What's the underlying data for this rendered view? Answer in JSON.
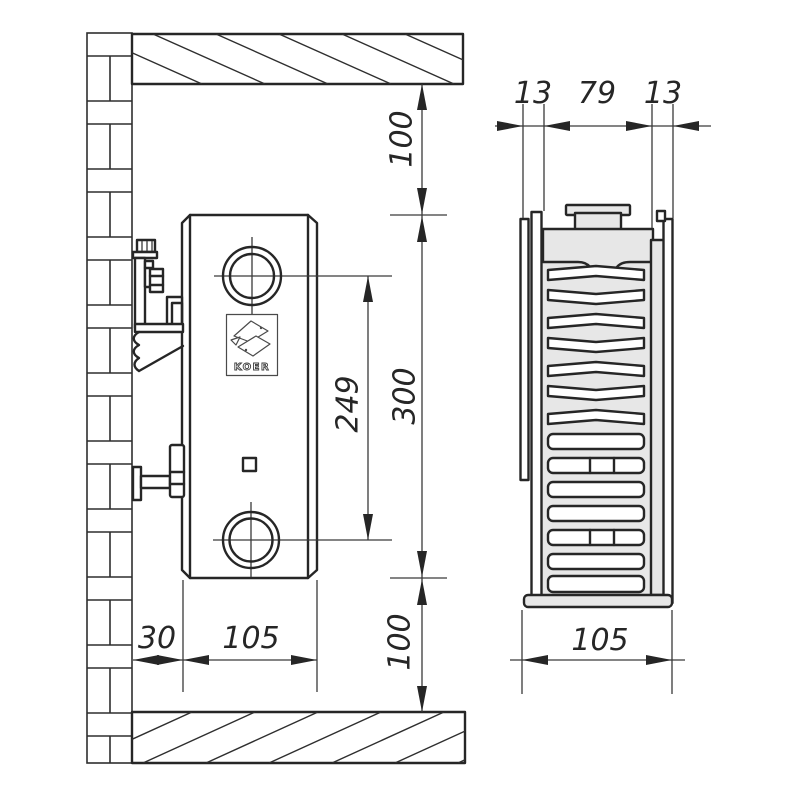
{
  "brand": {
    "logo_text": "KOER"
  },
  "front_view": {
    "top_clearance": "100",
    "radiator_height": "300",
    "port_spacing": "249",
    "bottom_clearance": "100",
    "wall_offset": "30",
    "width": "105"
  },
  "side_view": {
    "front_panel": "13",
    "core": "79",
    "back_panel": "13",
    "depth": "105"
  },
  "colors": {
    "line": "#262626",
    "light_fill": "#e7e7e7",
    "background": "#ffffff"
  }
}
